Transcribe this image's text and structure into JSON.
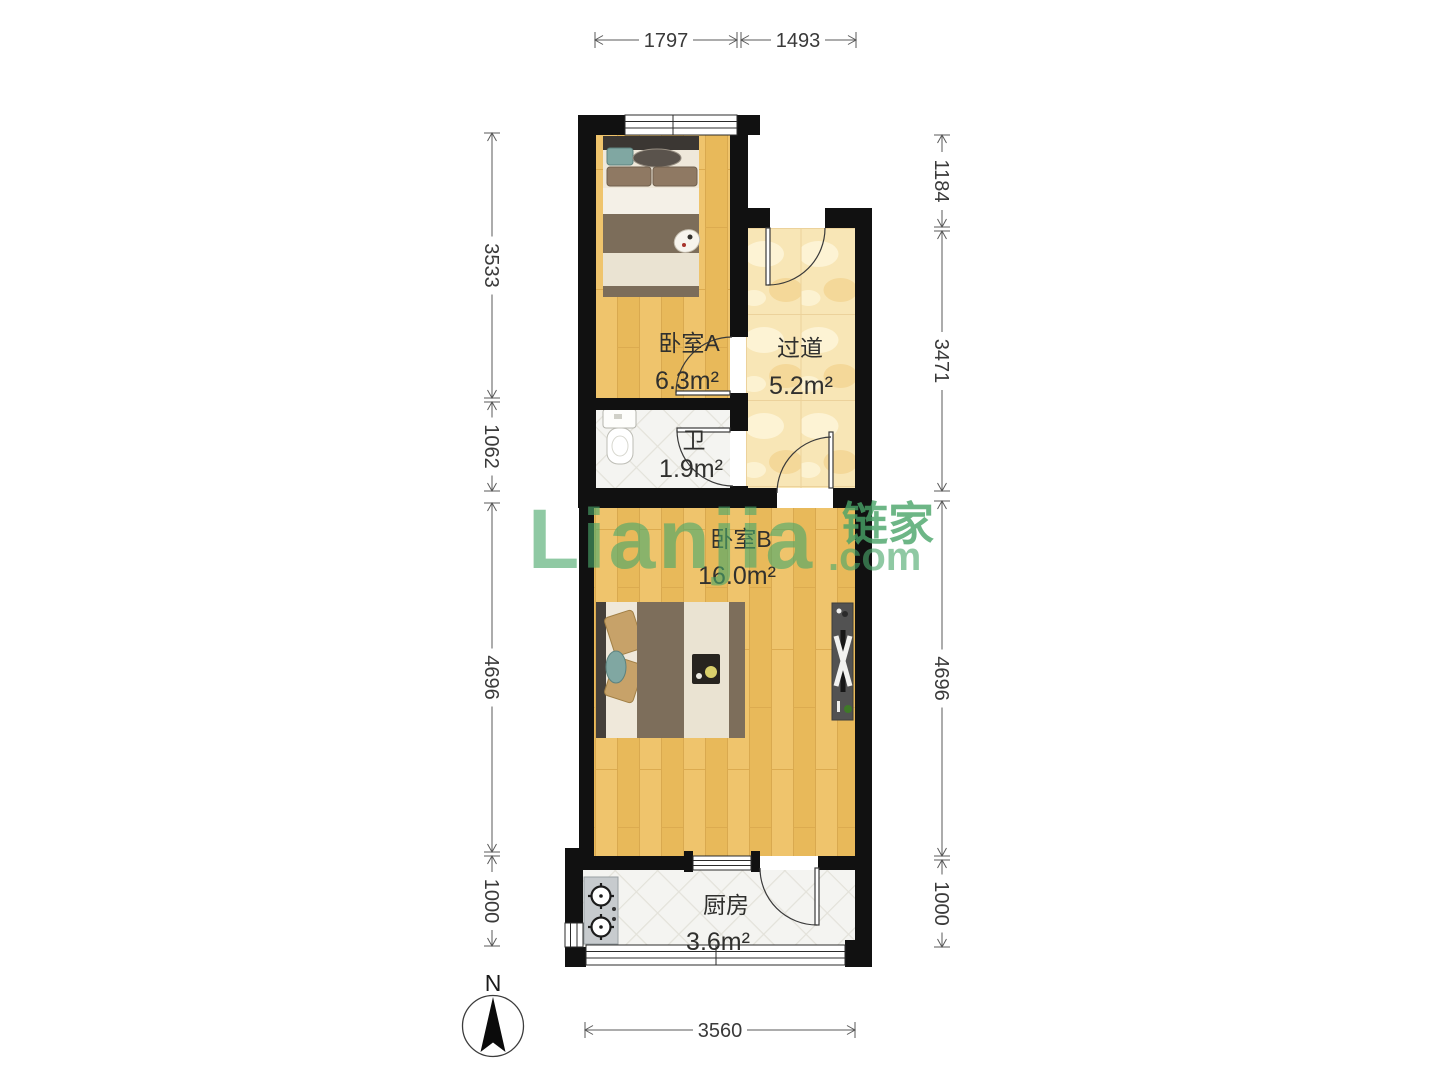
{
  "brand": {
    "name": "Lianjia",
    "suffix": ".com",
    "cn": "链家"
  },
  "compass": {
    "north_label": "N"
  },
  "rooms": {
    "bedroom_a": {
      "name": "卧室A",
      "area": "6.3m²"
    },
    "hallway": {
      "name": "过道",
      "area": "5.2m²"
    },
    "bathroom": {
      "name": "卫",
      "area": "1.9m²"
    },
    "bedroom_b": {
      "name": "卧室B",
      "area": "16.0m²"
    },
    "kitchen": {
      "name": "厨房",
      "area": "3.6m²"
    }
  },
  "dims": {
    "top": [
      "1797",
      "1493"
    ],
    "left": [
      "3533",
      "1062",
      "4696",
      "1000"
    ],
    "right": [
      "1184",
      "3471",
      "4696",
      "1000"
    ],
    "bottom": [
      "3560"
    ]
  },
  "colors": {
    "wall": "#111111",
    "wood_floor": "#eec167",
    "marble_floor": "#f8e6b6",
    "tile_floor": "#f4f4f1",
    "watermark_green": "#4aa86a",
    "dimension_line": "#5a5a5a"
  }
}
